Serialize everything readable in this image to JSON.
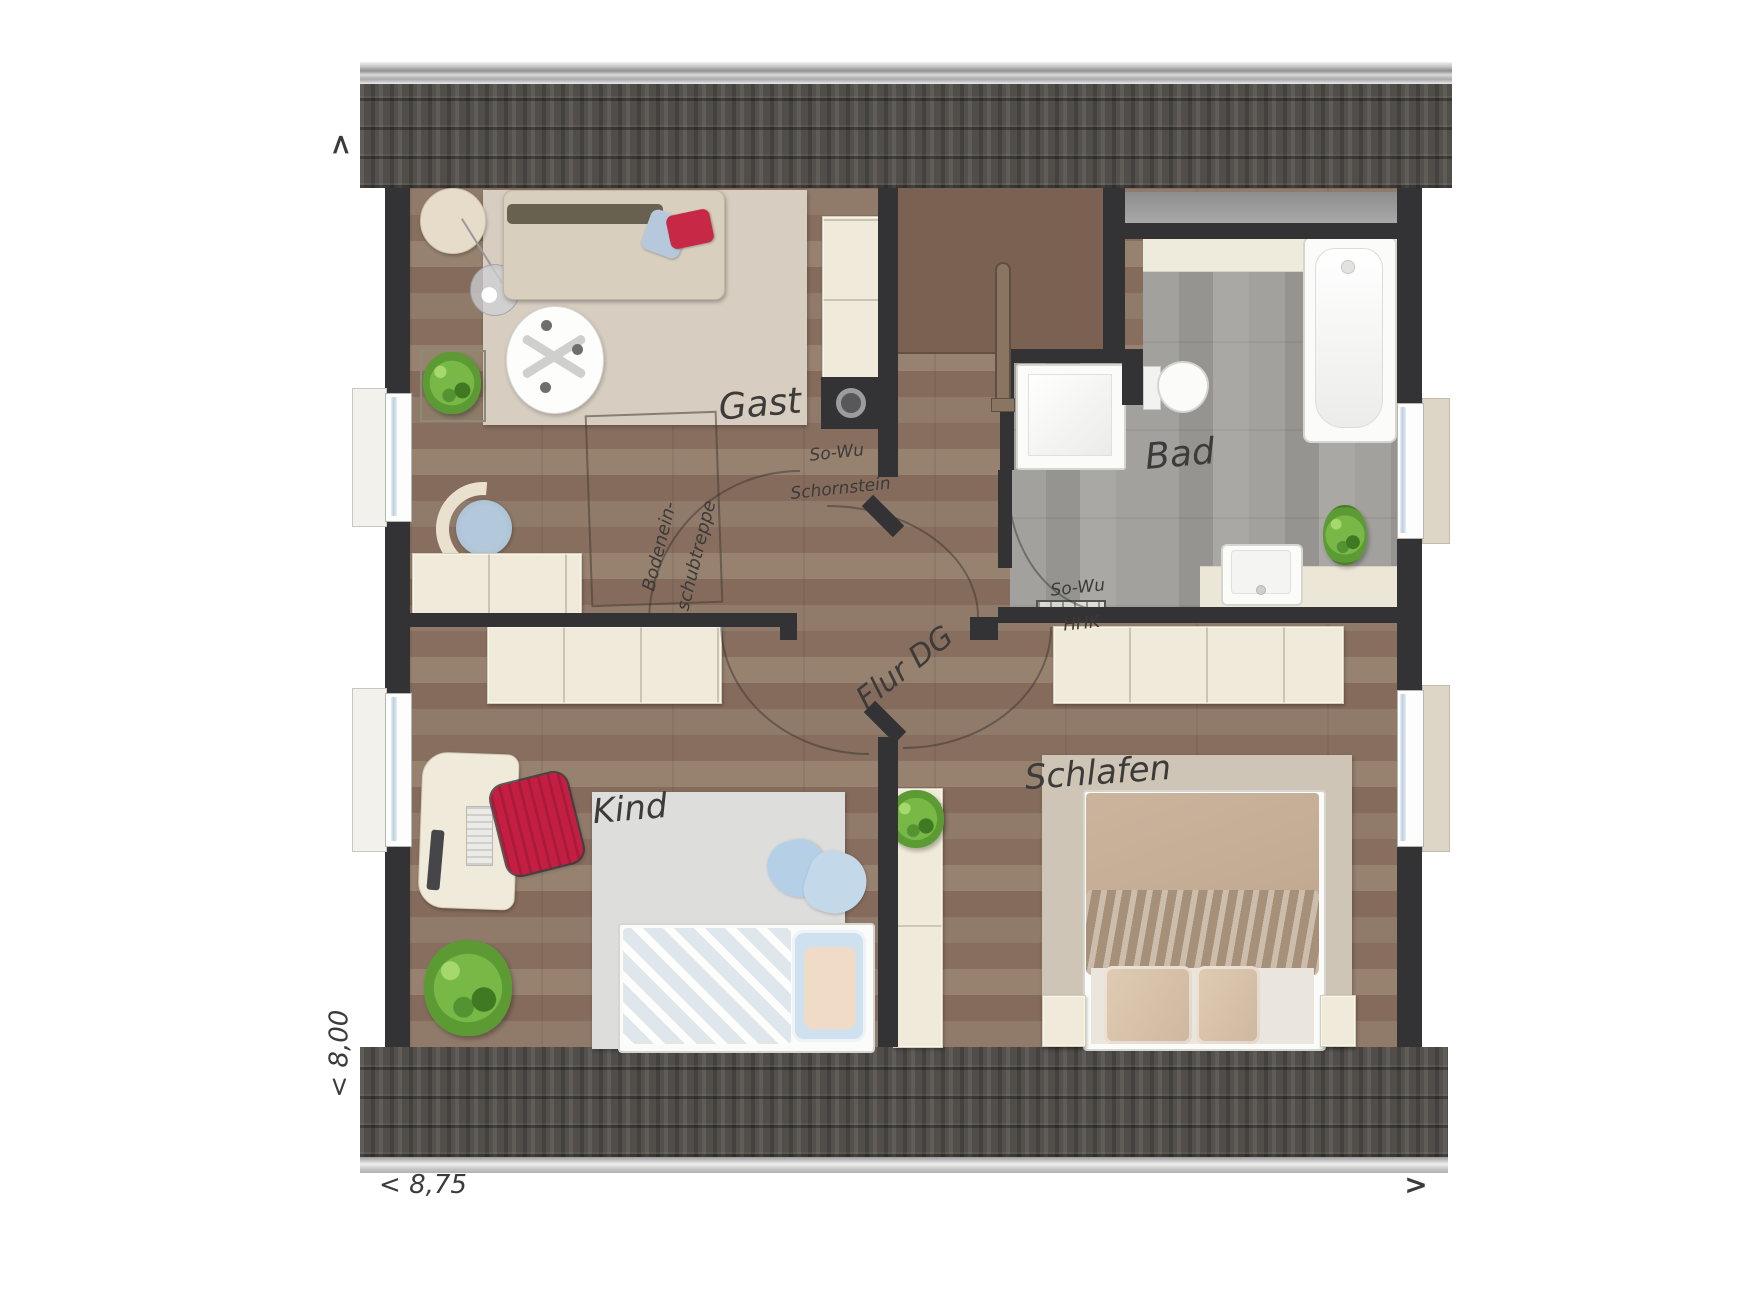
{
  "plan": {
    "type": "floor-plan",
    "storey": "DG (Dachgeschoss / attic floor)",
    "rooms": [
      {
        "id": "gast",
        "label": "Gast"
      },
      {
        "id": "bad",
        "label": "Bad"
      },
      {
        "id": "kind",
        "label": "Kind"
      },
      {
        "id": "schlafen",
        "label": "Schlafen"
      },
      {
        "id": "flur",
        "label": "Flur DG"
      }
    ],
    "annotations": [
      {
        "id": "schornstein",
        "line1": "So-Wu",
        "line2": "Schornstein"
      },
      {
        "id": "hhk",
        "line1": "So-Wu",
        "line2": "HHK"
      },
      {
        "id": "bodentreppe",
        "line1": "Bodenein-",
        "line2": "schubtreppe"
      }
    ],
    "dimensions": {
      "width": "< 8,75",
      "depth": "< 8,00"
    },
    "arrows": {
      "up": ">",
      "right": ">"
    },
    "colors": {
      "wall": "#333336",
      "roof_tile": "#514e4a",
      "floor_wood": "#8c7566",
      "floor_bath": "#9d9c99",
      "furniture_cream": "#efead9",
      "rug_gast": "#d7cdc0",
      "rug_kind": "#dddddb",
      "rug_schlafen": "#cfc5b7",
      "bed_beige": "#c6ae96",
      "bed_blue": "#c2d7e9",
      "accent_red": "#c52443",
      "plant_green": "#67a83d"
    }
  }
}
